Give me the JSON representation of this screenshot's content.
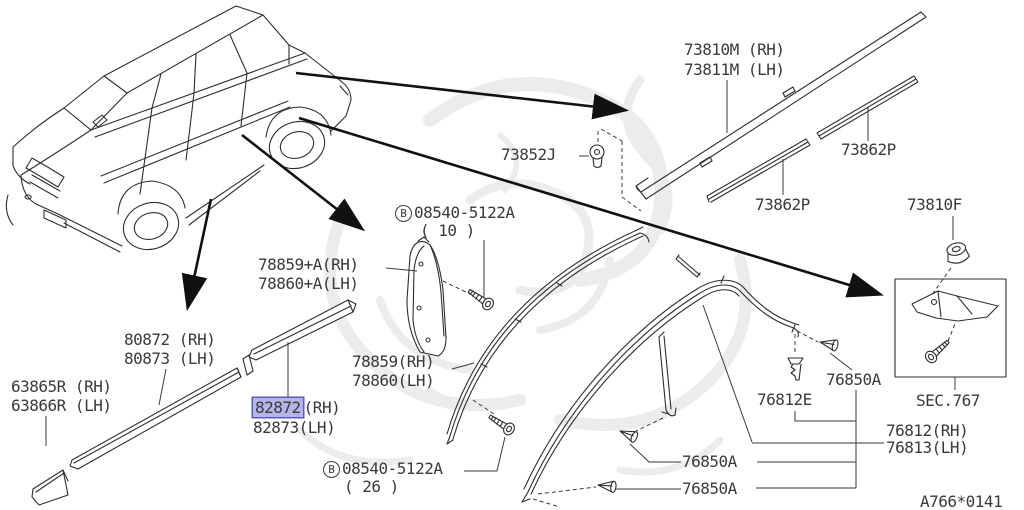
{
  "colors": {
    "line": "#2e2e2e",
    "text": "#3a3a3a",
    "highlight_fill": "rgba(120,120,215,0.55)",
    "highlight_border": "#5a5ac0",
    "watermark": "#ececec"
  },
  "labels": {
    "roof_molding_line1": "73810M (RH)",
    "roof_molding_line2": "73811M (LH)",
    "clip_73852j": "73852J",
    "strip_73862p_lower": "73862P",
    "strip_73862p_upper": "73862P",
    "grommet_73810f": "73810F",
    "screw_top_b": "B",
    "screw_top": "08540-5122A",
    "screw_top_qty": "( 10 )",
    "pillar_line1": "78859+A(RH)",
    "pillar_line2": "78860+A(LH)",
    "molding_80872_line1": "80872 (RH)",
    "molding_80872_line2": "80873 (LH)",
    "stone_guard_line1": "63865R (RH)",
    "stone_guard_line2": "63866R (LH)",
    "molding_82872_part": "82872",
    "molding_82872_suffix": "(RH)",
    "molding_82872_line2": "82873(LH)",
    "sash_line1": "78859(RH)",
    "sash_line2": "78860(LH)",
    "screw_bottom_b": "B",
    "screw_bottom": "08540-5122A",
    "screw_bottom_qty": "( 26 )",
    "clip_76812e": "76812E",
    "clip_76850a_top": "76850A",
    "clip_76850a_mid": "76850A",
    "clip_76850a_bottom": "76850A",
    "corner_76812_line1": "76812(RH)",
    "corner_76812_line2": "76813(LH)",
    "section_ref": "SEC.767",
    "drawing_ref": "A766*0141"
  }
}
